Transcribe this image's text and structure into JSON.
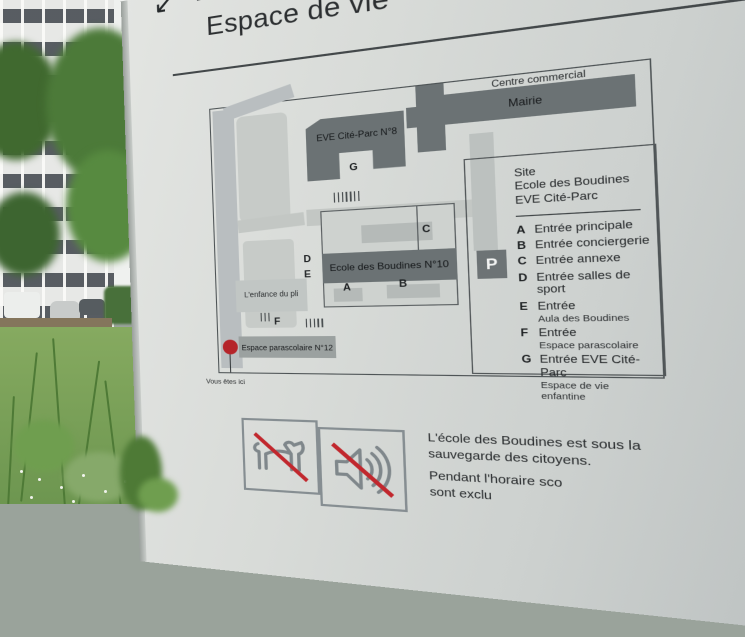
{
  "sign": {
    "header": {
      "arrow_icon": "↙",
      "title": "Espace de vie"
    },
    "map": {
      "area_labels": {
        "centre_commercial": "Centre commercial",
        "mairie": "Mairie",
        "eve_cite_parc": "EVE Cité-Parc N°8",
        "ecole_boudines": "Ecole des Boudines N°10",
        "enfance": "L'enfance du pli",
        "parascolaire": "Espace parascolaire N°12"
      },
      "markers": {
        "a": "A",
        "b": "B",
        "c": "C",
        "d": "D",
        "e": "E",
        "f": "F",
        "g": "G"
      },
      "parking_label": "P",
      "you_are_here": "Vous êtes ici"
    },
    "legend": {
      "site_lines": [
        "Site",
        "Ecole des Boudines",
        "EVE Cité-Parc"
      ],
      "entries": [
        {
          "key": "A",
          "label": "Entrée principale"
        },
        {
          "key": "B",
          "label": "Entrée conciergerie"
        },
        {
          "key": "C",
          "label": "Entrée annexe"
        },
        {
          "key": "D",
          "label": "Entrée salles de sport"
        },
        {
          "key": "E",
          "label": "Entrée",
          "sub": "Aula des Boudines"
        },
        {
          "key": "F",
          "label": "Entrée",
          "sub": "Espace parascolaire"
        },
        {
          "key": "G",
          "label": "Entrée EVE Cité-Parc",
          "sub": "Espace de vie enfantine"
        }
      ]
    },
    "pictograms": [
      {
        "name": "no-dogs"
      },
      {
        "name": "no-noise"
      }
    ],
    "notices": {
      "line1": "L'école des Boudines est sous la",
      "line2": "sauvegarde des citoyens.",
      "line3": "Pendant l'horaire sco",
      "line4": "sont exclu"
    },
    "colors": {
      "panel": "#d6d9d6",
      "building": "#6b7274",
      "red": "#c1272d",
      "text": "#26292b"
    }
  }
}
